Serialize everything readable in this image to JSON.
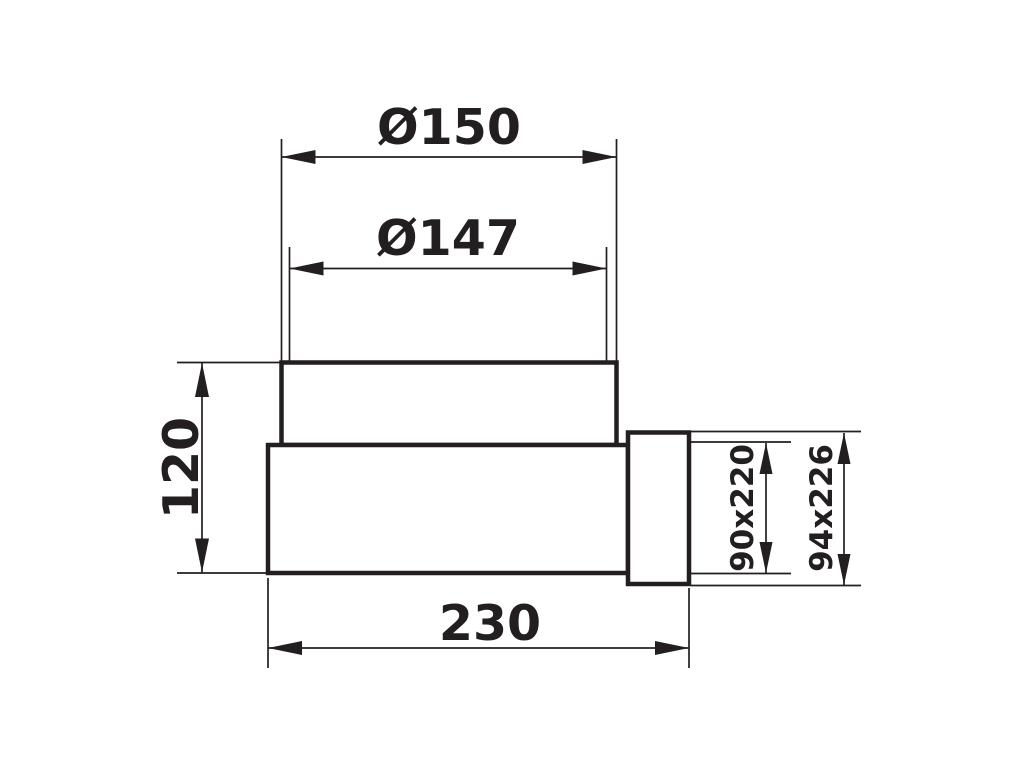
{
  "drawing": {
    "description": "technical-dimension-drawing-duct-adapter",
    "background_color": "#ffffff",
    "line_color": "#231f20",
    "dimensions": {
      "outer_diameter": "Ø150",
      "inner_diameter": "Ø147",
      "height": "120",
      "length": "230",
      "duct_inner": "90x220",
      "duct_outer": "94x226"
    }
  }
}
